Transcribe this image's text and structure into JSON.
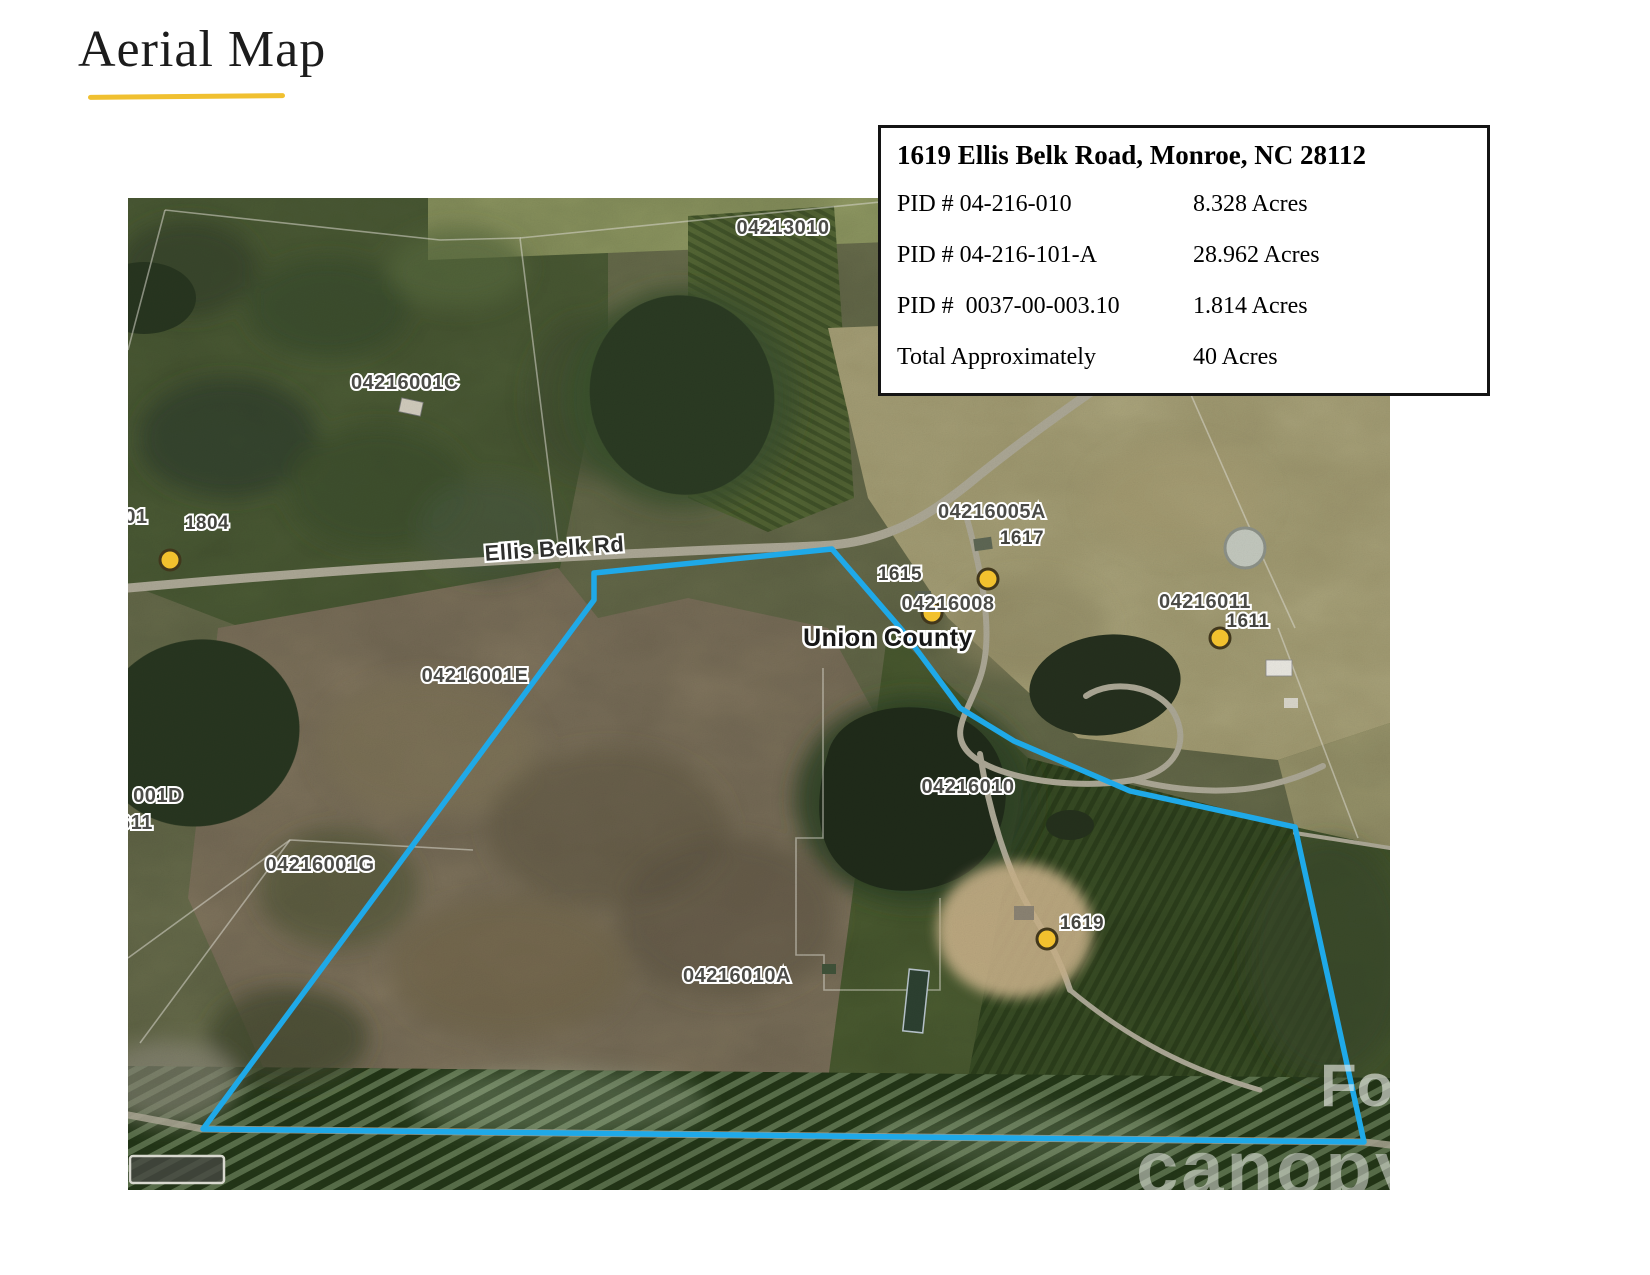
{
  "page": {
    "title": "Aerial Map"
  },
  "info_box": {
    "title": "1619 Ellis Belk Road, Monroe, NC 28112",
    "rows": [
      {
        "label": "PID # 04-216-010",
        "value": "8.328 Acres"
      },
      {
        "label": "PID # 04-216-101-A",
        "value": "28.962 Acres"
      },
      {
        "label": "PID #  0037-00-003.10",
        "value": "1.814 Acres"
      },
      {
        "label": "Total Approximately",
        "value": "40 Acres"
      }
    ]
  },
  "map": {
    "road_label": "Ellis Belk Rd",
    "county_label": "Union County",
    "parcel_labels": [
      {
        "text": "04213010"
      },
      {
        "text": "04216001C"
      },
      {
        "text": "04216005A"
      },
      {
        "text": "04216008"
      },
      {
        "text": "04216011"
      },
      {
        "text": "04216001E"
      },
      {
        "text": "04216001G"
      },
      {
        "text": "04216010"
      },
      {
        "text": "04216010A"
      }
    ],
    "address_labels": [
      {
        "text": "1804"
      },
      {
        "text": "1617"
      },
      {
        "text": "1615"
      },
      {
        "text": "1611"
      },
      {
        "text": "1619"
      }
    ],
    "partial_labels": [
      {
        "text": "01"
      },
      {
        "text": "001D"
      },
      {
        "text": "611"
      }
    ],
    "watermark": {
      "big": "Fo",
      "logo": "canopy"
    },
    "colors": {
      "boundary": "#1FA9E8",
      "marker": "#F2C12E",
      "accent_underline": "#F0C030"
    }
  }
}
